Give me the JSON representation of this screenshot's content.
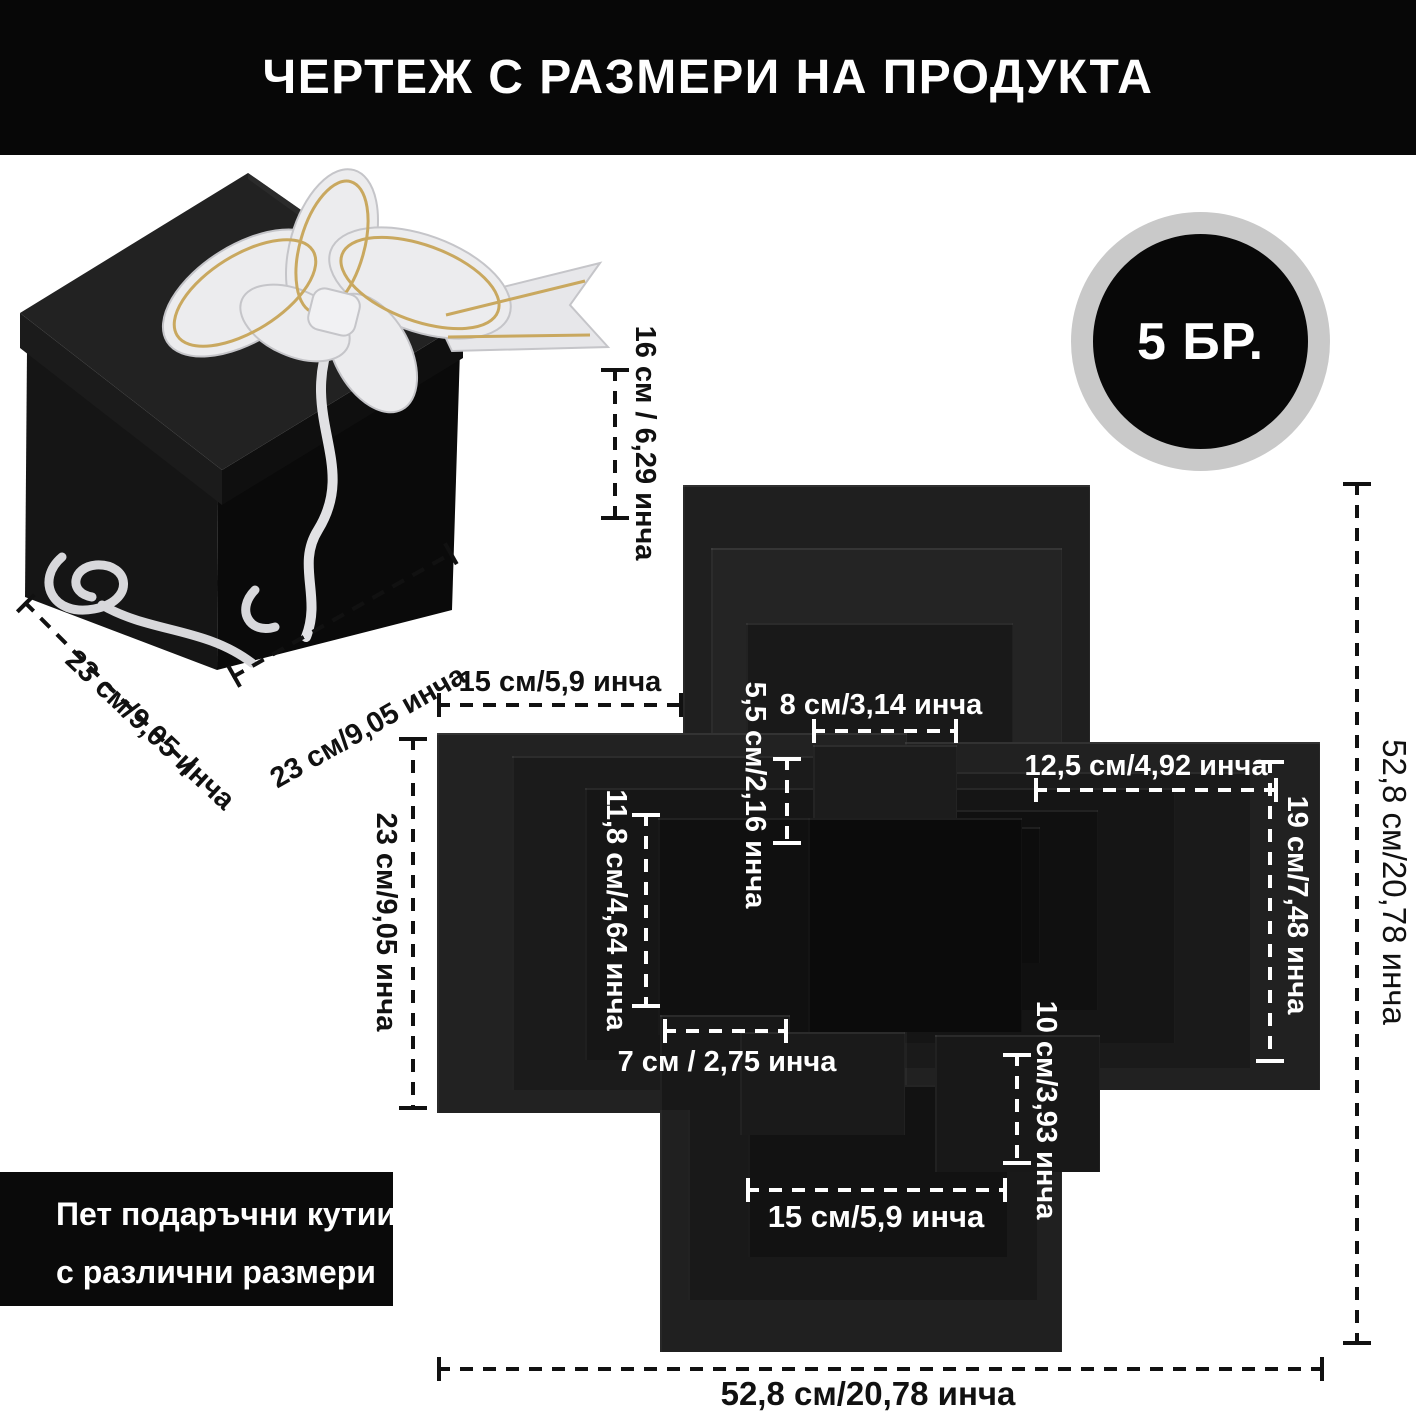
{
  "header": {
    "title": "ЧЕРТЕЖ С РАЗМЕРИ НА ПРОДУКТА"
  },
  "badge": {
    "label": "5 БР."
  },
  "note": {
    "line1": "Пет подаръчни кутии",
    "line2": "с различни размери"
  },
  "photo": {
    "height_dim": "16 см / 6,29 инча",
    "depth_dim": "23 см/9,05 инча",
    "width_dim": "23 см/9,05 инча"
  },
  "diagram": {
    "top_flap_width": "15 см/5,9 инча",
    "top_tab_width": "8 см/3,14 инча",
    "top_tab_height": "5,5 см/2,16 инча",
    "right_panel_width": "12,5 см/4,92 инча",
    "right_panel_height": "19 см/7,48 инча",
    "left_inner_height": "11,8 см/4,64 инча",
    "left_flap_height": "23 см/9,05 инча",
    "left_tab_width": "7 см / 2,75 инча",
    "bottom_tab_height": "10 см/3,93 инча",
    "bottom_inner_width": "15 см/5,9 инча",
    "total_height": "52,8 см/20,78 инча",
    "total_width": "52,8 см/20,78 инча"
  },
  "colors": {
    "background": "#ffffff",
    "header_bg": "#070707",
    "panel_dark": "#0b0b0b",
    "badge_ring": "#c9c9c9",
    "ribbon": "#ececee",
    "ribbon_gold": "#c9a85f"
  }
}
